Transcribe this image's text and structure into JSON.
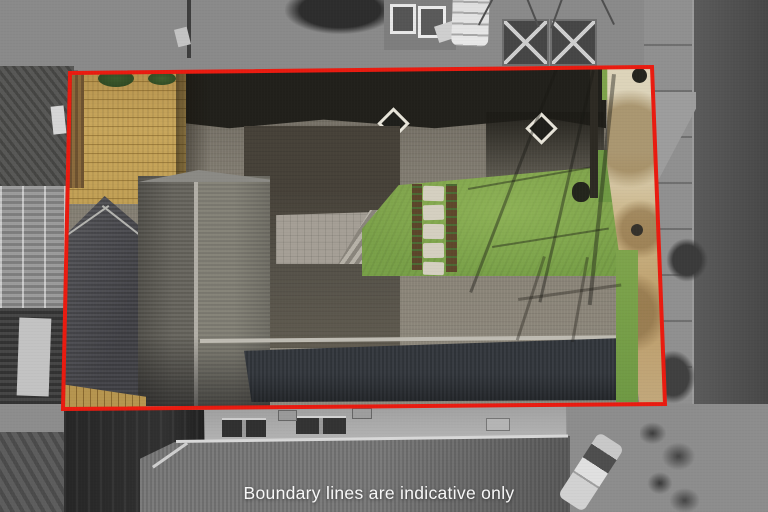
{
  "caption": {
    "text": "Boundary lines are indicative only"
  },
  "overlay": {
    "boundary_points": "70,73 652,67 665,404 63,409"
  },
  "palette": {
    "boundary-red": "#ea1b10",
    "caption-white": "#f7f7f7",
    "lawn-green": "#7fa34b",
    "deck-tan": "#c9a75c",
    "path-beige": "#ddd4ba",
    "driveway-grey": "#7f7a6f",
    "shadow-dark": "#21201b",
    "roof-upper-grey": "#8d8a82",
    "roof-lower-charcoal": "#33373c",
    "roof-ridge-light": "#bfbcb3",
    "mono-road": "#4c4c4c",
    "mono-footpath": "#909090",
    "mono-ground": "#8d8d8d",
    "mono-building-dark": "#2b2b2b"
  }
}
